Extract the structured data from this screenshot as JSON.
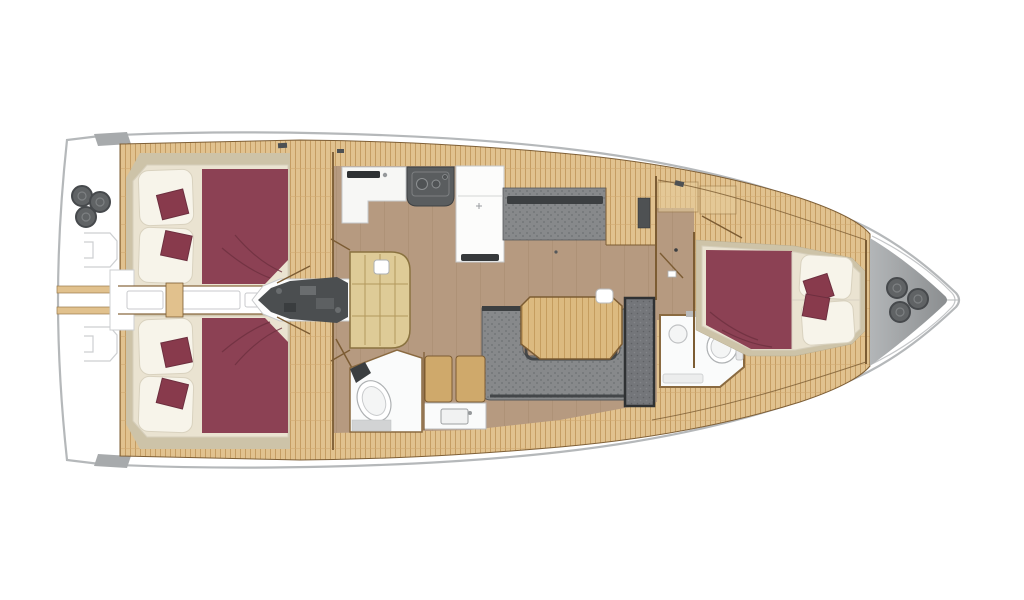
{
  "diagram": {
    "type": "sailing-yacht-interior-floor-plan",
    "view": "top-down",
    "bow_direction": "right",
    "regions": [
      "stern-swim-platform",
      "stern-winches",
      "port-aft-cabin",
      "starboard-aft-cabin",
      "center-corridor",
      "engine-compartment",
      "companionway-steps",
      "galley-sink-counter",
      "galley-stove",
      "galley-refrigerator",
      "salon-settee",
      "salon-table",
      "salon-dinette-sofa",
      "mast-foot",
      "aft-head-toilet",
      "aft-head-shower",
      "aft-head-sink",
      "shower-grate",
      "forward-head",
      "forward-cabin-berth",
      "anchor-locker",
      "bow-windlass"
    ]
  },
  "palette": {
    "hull_fill": "#ffffff",
    "hull_outline": "#b5b8ba",
    "tab_gray": "#a7aaac",
    "deck_wood": "#e1c18d",
    "deck_stripe": "#c49c60",
    "deck_seam": "#cfa76e",
    "trim_brown": "#7c5c33",
    "sole": "#b69a80",
    "sole_stripe": "#a3876d",
    "khaki": "#cdc3a8",
    "bed_base": "#eae3d1",
    "bed_edge": "#d6cfbc",
    "pillow": "#f7f4ea",
    "pillow_stroke": "#d9d2bf",
    "maroon": "#8c4154",
    "maroon_dark": "#6d2f3f",
    "cushion": "#883a4c",
    "uph_gray": "#87898b",
    "uph_dot": "#6e7173",
    "uph_dark": "#3c3f41",
    "fixture_white": "#fafbfb",
    "fixture_stroke": "#bcbec0",
    "steel_gray": "#606365",
    "steel_ring": "#46494c",
    "engine_gray": "#4b4e50",
    "engine_light": "#6a6d6f",
    "locker_light": "#b3b6b8",
    "locker_dark": "#8b8e90",
    "table_wood": "#dcba80",
    "table_stripe": "#c59d5f",
    "steps_wood": "#decb97",
    "steps_line": "#b3985c",
    "grate": "#74767a",
    "grate_frame": "#2f3133",
    "counter_white": "#f7f7f5",
    "stove_gray": "#5a5d5f",
    "mat_gray": "#d2d3d4",
    "outline_faint": "#cdcfd1"
  }
}
